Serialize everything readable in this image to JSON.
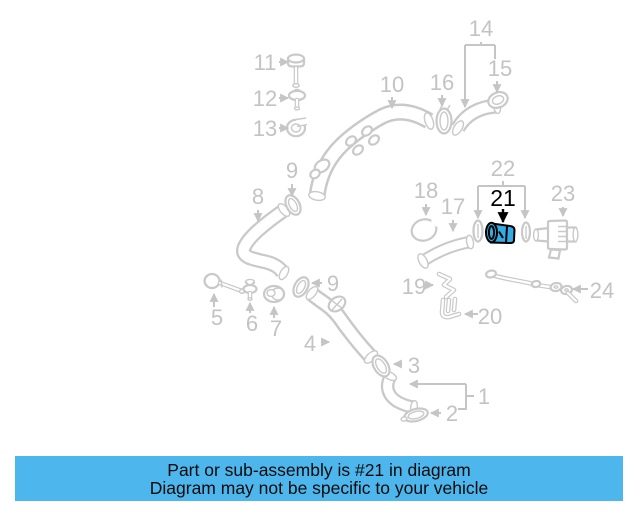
{
  "caption": {
    "line1": "Part or sub-assembly is #21 in diagram",
    "line2": "Diagram may not be specific to your vehicle"
  },
  "part_labels": {
    "n1": "1",
    "n2": "2",
    "n3": "3",
    "n4": "4",
    "n5": "5",
    "n6": "6",
    "n7": "7",
    "n8": "8",
    "n9": "9",
    "n10": "10",
    "n11": "11",
    "n12": "12",
    "n13": "13",
    "n14": "14",
    "n15": "15",
    "n16": "16",
    "n17": "17",
    "n18": "18",
    "n19": "19",
    "n20": "20",
    "n21": "21",
    "n22": "22",
    "n23": "23",
    "n24": "24"
  },
  "colors": {
    "highlight_fill": "#35abe3",
    "highlight_outline": "#000000",
    "caption_bg": "#4db7ed",
    "caption_text": "#000000",
    "line_art": "#c9c9c9",
    "label_text": "#c3c3c3"
  }
}
